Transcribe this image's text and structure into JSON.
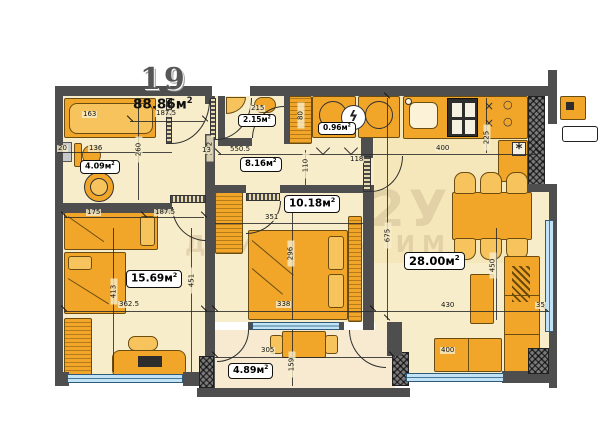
{
  "unit": {
    "number": "19",
    "total_area": "88.86м",
    "total_area_sup": "2"
  },
  "watermark": {
    "line1": "2У",
    "line2": "ДВИЖИМИ ИМ"
  },
  "rooms": {
    "bathroom": {
      "area": "4.09м",
      "sup": "2"
    },
    "wc": {
      "area": "2.15м",
      "sup": "2"
    },
    "utility": {
      "area": "0.96м",
      "sup": "2"
    },
    "hallway": {
      "area": "8.16м",
      "sup": "2"
    },
    "bedroom": {
      "area": "10.18м",
      "sup": "2"
    },
    "bedroom2": {
      "area": "15.69м",
      "sup": "2"
    },
    "living": {
      "area": "28.00м",
      "sup": "2"
    },
    "balcony": {
      "area": "4.89м",
      "sup": "2"
    }
  },
  "dimensions": {
    "bath_tub": "163",
    "bath_seg1": "20",
    "bath_seg2": "136",
    "bath_height": "260",
    "wall_col": "222",
    "width_top": "187.5",
    "wc_width": "215",
    "wardrobe_depth": "80",
    "hall_length": "550.5",
    "hall_width": "110",
    "niche": "13",
    "door": "118",
    "kitchen_width": "400",
    "kitchen_depth": "225",
    "room2_seg1": "175",
    "room2_seg2": "187.5",
    "room2_height1": "413",
    "room2_height2": "451",
    "room2_width": "362.5",
    "bedroom_width": "351",
    "bedroom_height": "296",
    "bedroom_width2": "338",
    "apt_depth": "675",
    "living_width": "430",
    "living_depth": "450",
    "sofa_width": "400",
    "wall_gap": "35",
    "balcony_width": "305",
    "balcony_depth": "159"
  },
  "icons": {
    "lightning": "ϟ",
    "snowflake": "*",
    "burner_x": "×",
    "burner_o": "○"
  }
}
